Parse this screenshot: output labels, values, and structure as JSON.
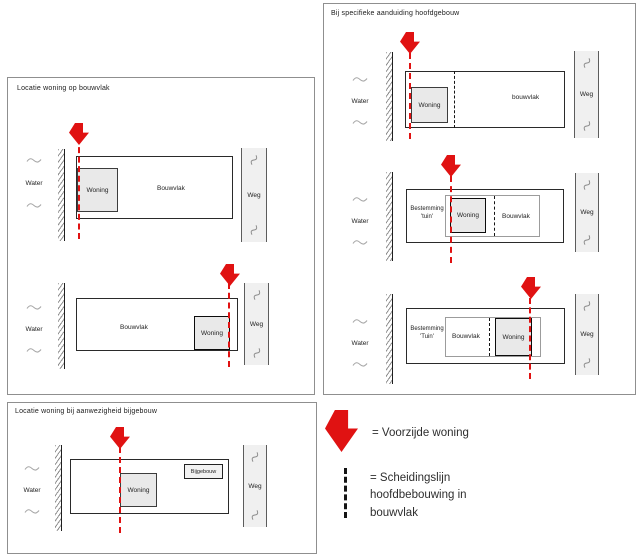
{
  "panels": {
    "top_left": {
      "title": "Locatie woning op bouwvlak",
      "diagrams": [
        {
          "water": "Water",
          "woning": "Woning",
          "bouwvlak": "Bouwvlak",
          "weg": "Weg"
        },
        {
          "water": "Water",
          "woning": "Woning",
          "bouwvlak": "Bouwvlak",
          "weg": "Weg"
        }
      ]
    },
    "top_right": {
      "title": "Bij specifieke aanduiding hoofdgebouw",
      "diagrams": [
        {
          "water": "Water",
          "woning": "Woning",
          "bouwvlak": "bouwvlak",
          "weg": "Weg"
        },
        {
          "water": "Water",
          "woning": "Woning",
          "bouwvlak": "Bouwvlak",
          "weg": "Weg",
          "bestemming": "Bestemming 'tuin'"
        },
        {
          "water": "Water",
          "woning": "Woning",
          "bouwvlak": "Bouwvlak",
          "weg": "Weg",
          "bestemming": "Bestemming 'Tuin'"
        }
      ]
    },
    "bottom_left": {
      "title": "Locatie woning bij aanwezigheid bijgebouw",
      "diagrams": [
        {
          "water": "Water",
          "woning": "Woning",
          "bijgebouw": "Bijgebouw",
          "weg": "Weg"
        }
      ]
    }
  },
  "legend": {
    "arrow_label": "= Voorzijde woning",
    "separator_label": "= Scheidingslijn hoofdbebouwing in bouwvlak"
  },
  "icons": {
    "front_arrow": "red-block-arrow-down",
    "wave": "water-wave-squiggle",
    "road_mark": "road-diagonal-mark",
    "separator_line": "black-dashed-line",
    "front_line": "red-dashed-line"
  },
  "colors": {
    "accent_red": "#e01212",
    "woning_fill": "#e9e9e9",
    "weg_fill": "#f0f0f0"
  }
}
